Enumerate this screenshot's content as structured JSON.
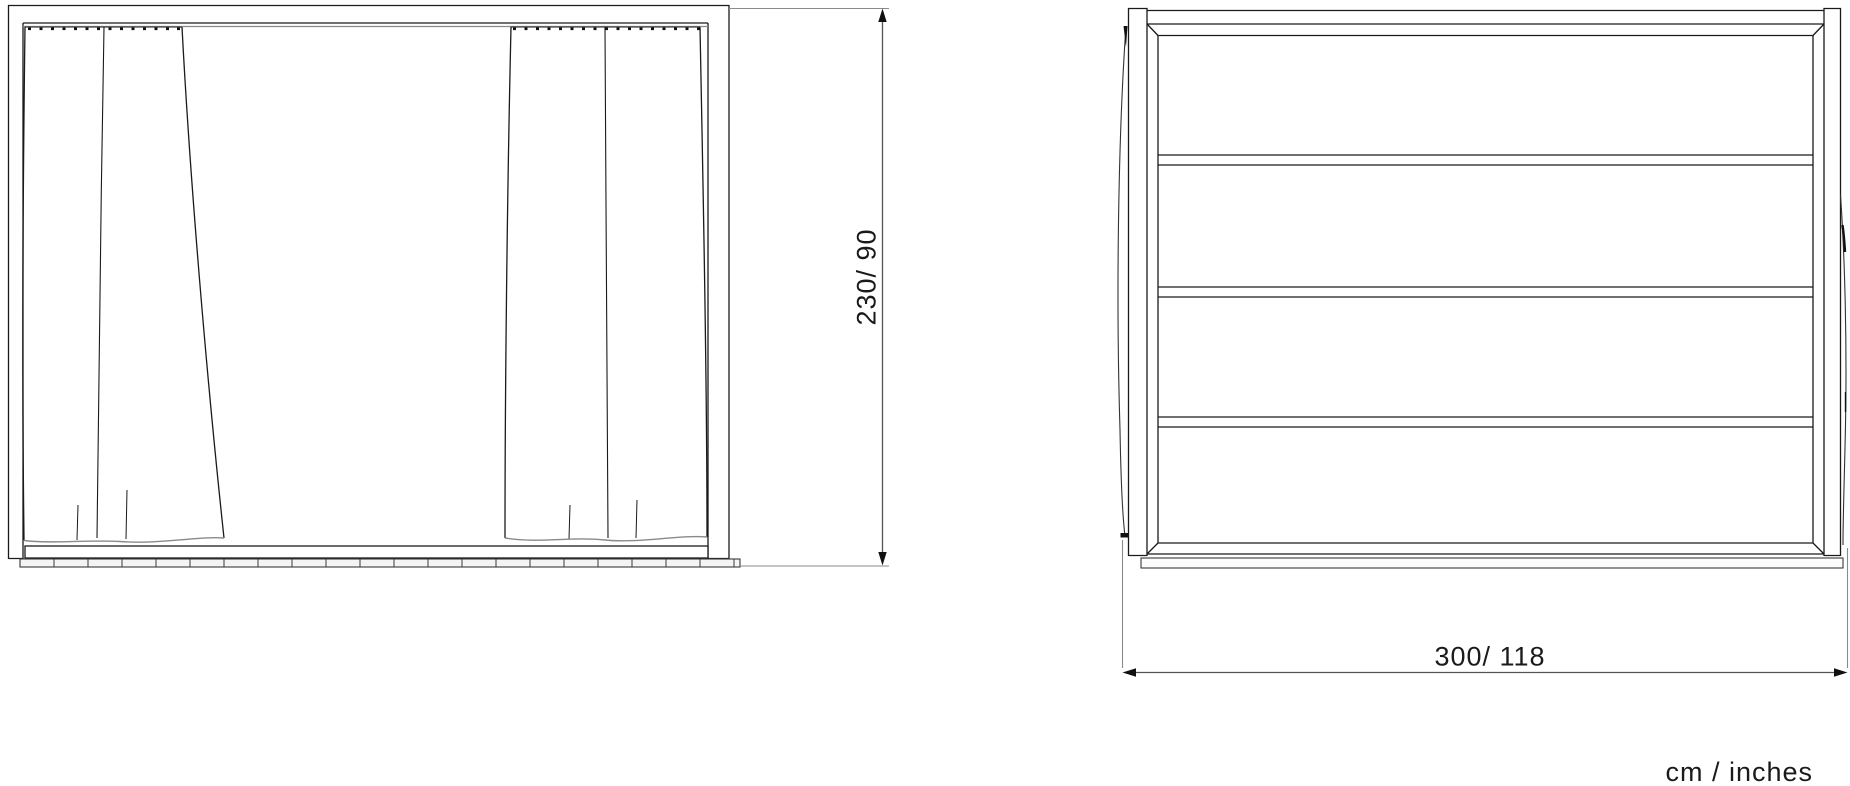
{
  "figure": {
    "type": "furniture-dimension-drawing",
    "front_view": {
      "curtain_panels": 2,
      "floor_track_segments": 21
    },
    "back_view": {
      "horizontal_panel_rows": 4
    }
  },
  "dimensions": {
    "height": {
      "label": "230/ 90",
      "cm": 230,
      "inches": 90
    },
    "width": {
      "label": "300/ 118",
      "cm": 300,
      "inches": 118
    },
    "units_label": "cm / inches"
  },
  "colors": {
    "background": "#ffffff",
    "main_line": "#1a1a1a",
    "light_line": "#8a8a8a",
    "dimension_line": "#555555",
    "text": "#1a1a1a"
  }
}
